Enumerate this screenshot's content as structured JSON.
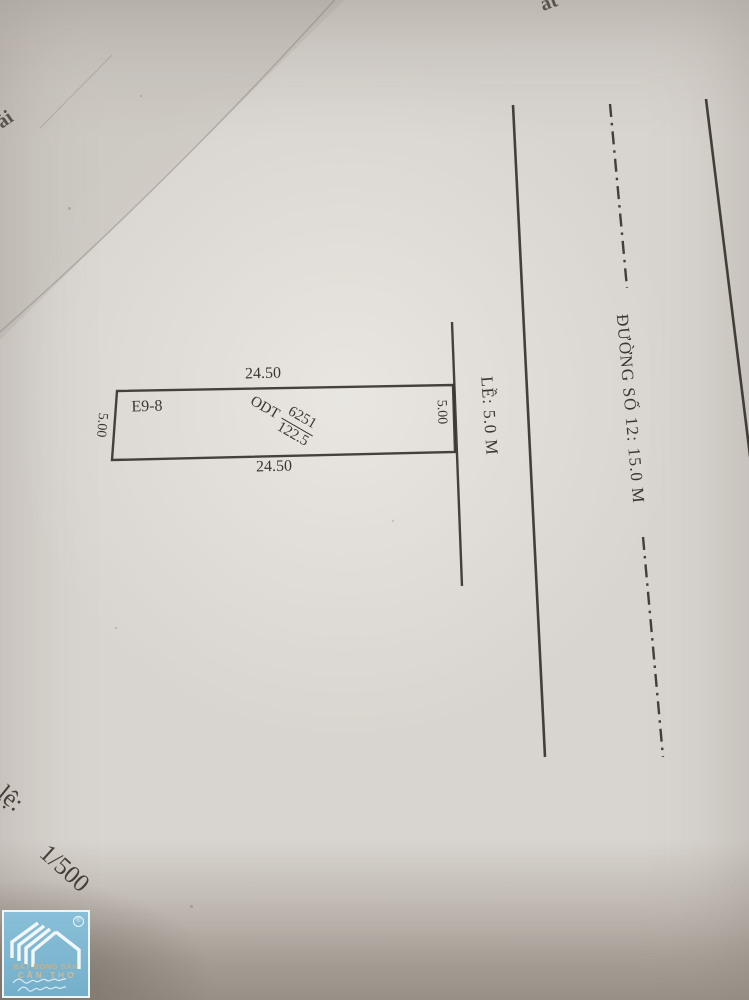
{
  "diagram": {
    "plot": {
      "id": "E9-8",
      "dim_top": "24.50",
      "dim_bottom": "24.50",
      "dim_left": "5.00",
      "dim_right": "5.00",
      "land_use_code": "ODT",
      "parcel_number": "6251",
      "area": "122.5"
    },
    "sidewalk_label": "LỀ: 5.0 M",
    "road_label": "ĐƯỜNG SỐ 12: 15.0 M",
    "scale_label_fragment": "lệ:",
    "scale_value": "1/500",
    "edge_fragment_top": "ất",
    "edge_fragment_left": "ải"
  },
  "logo": {
    "name_line1": "BẤT ĐỘNG SẢN",
    "name_line2": "CẦN THƠ",
    "registered_mark": "®"
  },
  "colors": {
    "paper": "#d8d4cf",
    "ink": "#2e2a24",
    "logo_blue": "#7eb7d2",
    "logo_text_tan": "#c4b291",
    "surface_shadow": "#8c8478"
  }
}
